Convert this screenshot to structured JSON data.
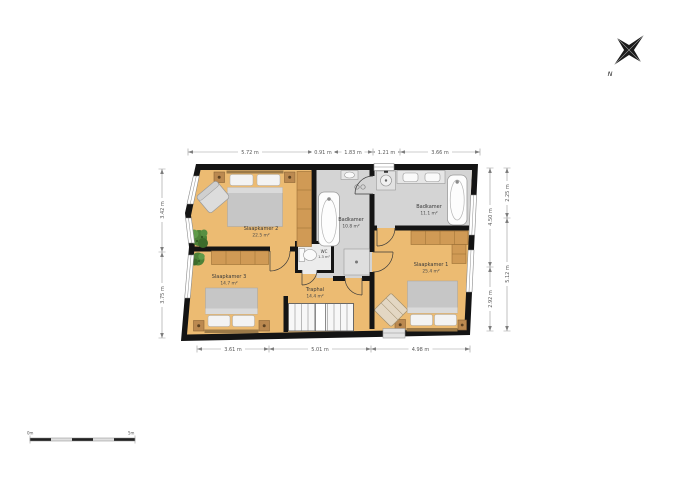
{
  "rooms": {
    "slaapkamer2": {
      "name": "Slaapkamer 2",
      "area": "22.5 m²"
    },
    "slaapkamer3": {
      "name": "Slaapkamer 3",
      "area": "14.7 m²"
    },
    "slaapkamer1": {
      "name": "Slaapkamer 1",
      "area": "25.4 m²"
    },
    "badkamer_center": {
      "name": "Badkamer",
      "area": "10.8 m²"
    },
    "badkamer_right": {
      "name": "Badkamer",
      "area": "11.1 m²"
    },
    "traphal": {
      "name": "Traphal",
      "area": "14.4 m²"
    },
    "wc": {
      "name": "WC",
      "area": "1.3 m²"
    }
  },
  "dimensions": {
    "top": [
      "5.72 m",
      "0.91 m",
      "1.83 m",
      "1.21 m",
      "3.66 m"
    ],
    "bottom": [
      "3.61 m",
      "5.01 m",
      "4.98 m"
    ],
    "left": [
      "3.42 m",
      "3.75 m"
    ],
    "right_inner": [
      "4.50 m",
      "2.92 m"
    ],
    "right_outer": [
      "2.25 m",
      "5.12 m"
    ]
  },
  "compass": {
    "label": "N"
  },
  "scale_bar": {
    "start_label": "0m",
    "end_label": "5m"
  },
  "colors": {
    "floor": "#ecbb72",
    "bathroom_floor": "#d4d4d4",
    "wardrobe": "#d09a55",
    "wall": "#141414",
    "plant": "#4d8238"
  }
}
